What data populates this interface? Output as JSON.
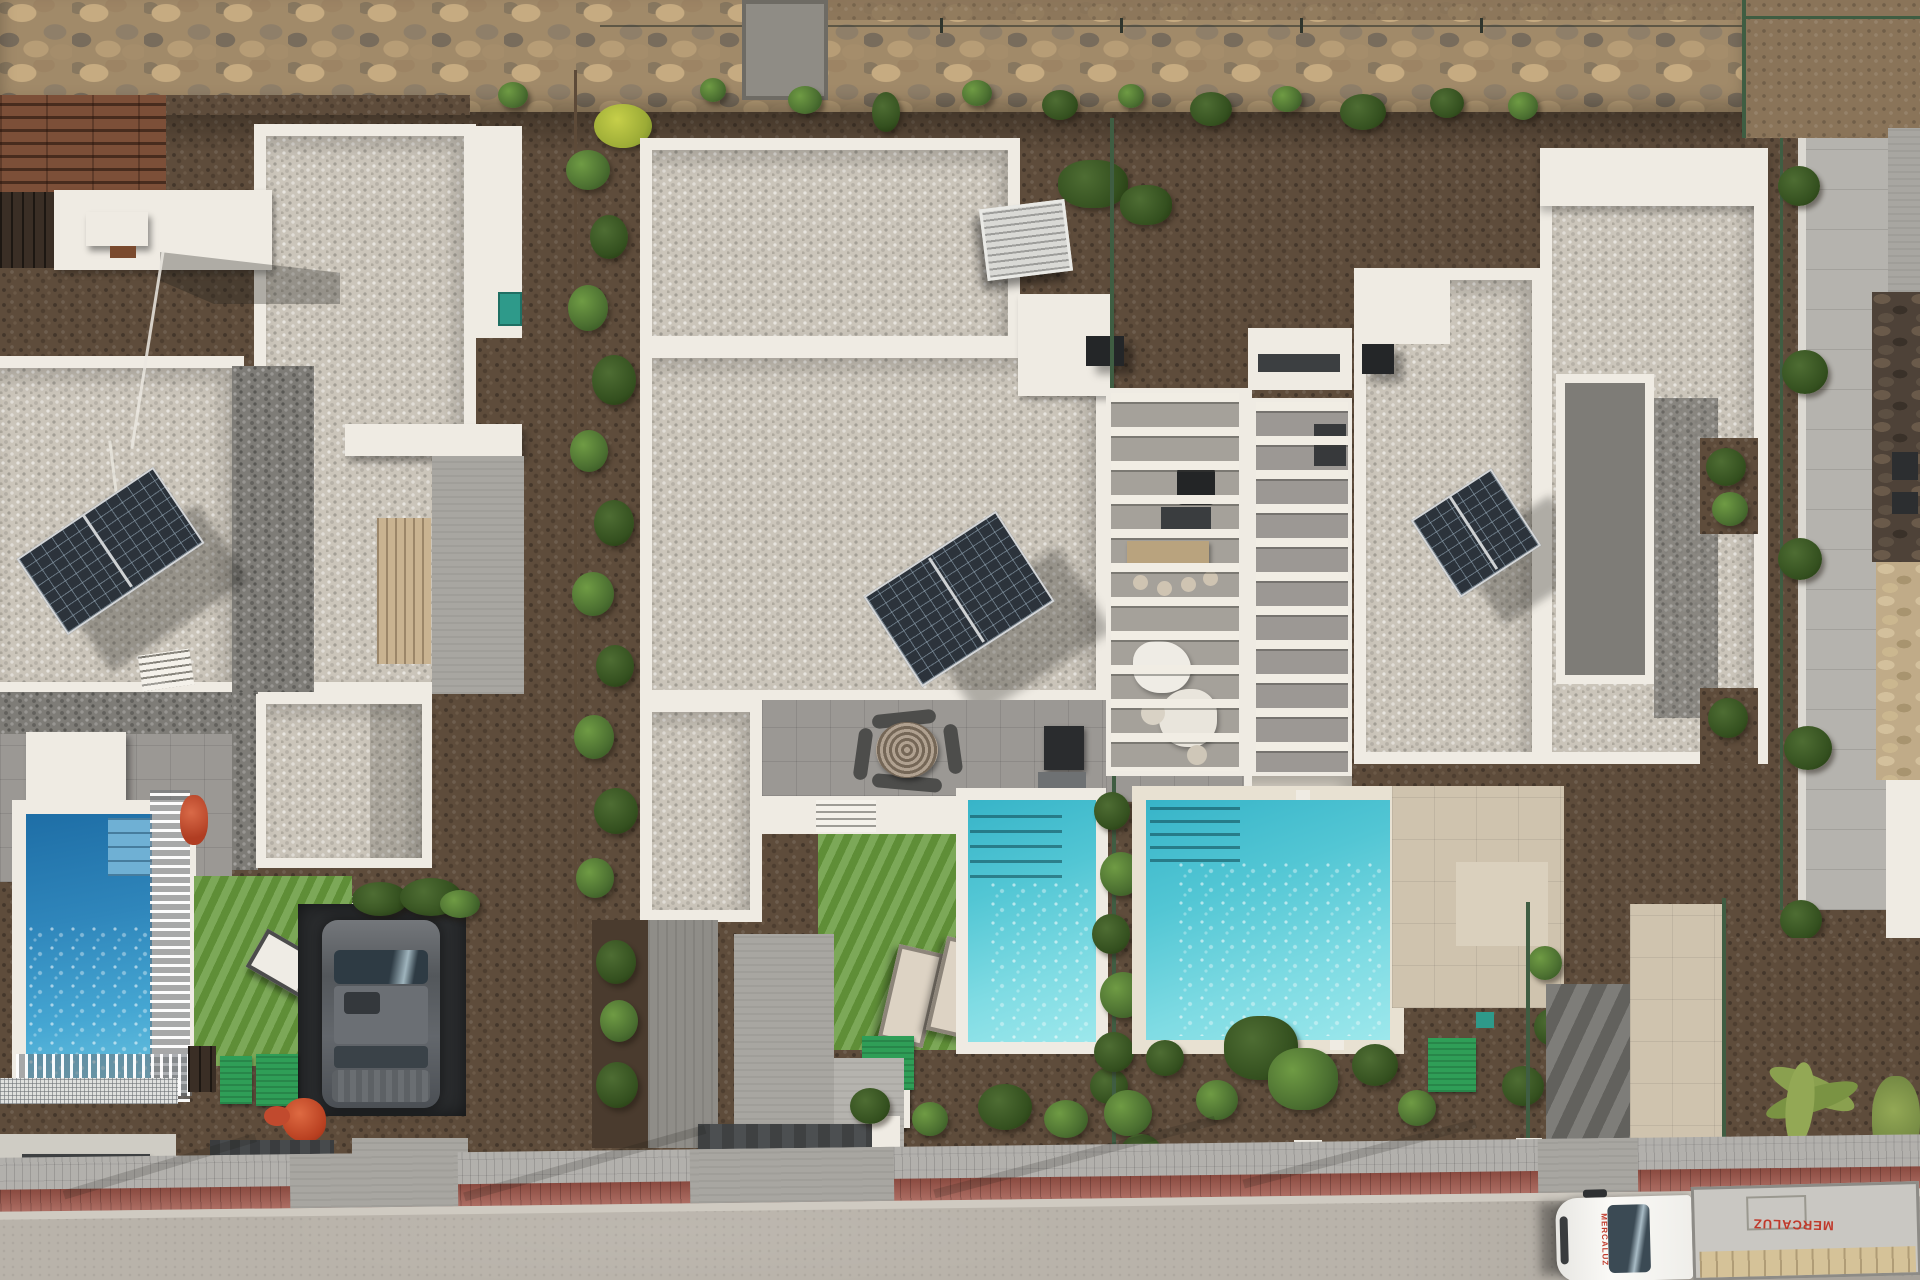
{
  "scene": {
    "type": "aerial-drone-photograph",
    "description": "Top-down drone view of three modern white villas with gravel flat roofs and solar panels, private pools and gardens, a rubble stone boundary wall at top, white pergola terraces between houses, and a street with sidewalk and a parked box truck at bottom right.",
    "villa_count": 3,
    "pool_count": 3
  },
  "palette": {
    "dirt": "#5e4c3b",
    "stone_wall": "#a18a69",
    "gravel_light": "#cbc5ba",
    "gravel_dark": "#7e7c77",
    "lawn": "#679a3c",
    "pool_deep": "#2f86bb",
    "pool_turquoise": "#52c6d4",
    "white_wall": "#efebe3",
    "asphalt": "#b9b3aa",
    "sidewalk": "#b2b0ac",
    "brick_stripe": "#a0564a",
    "terrace_beige": "#cfc3ae",
    "patio_grey": "#9b9894",
    "car_body": "#5a5e61",
    "statue_red": "#c14a2e",
    "truck_text": "#c0392b",
    "hedge_green": "#4c7031",
    "mat_green": "#2f9e57"
  },
  "truck": {
    "roof_text": "MERCALUZ",
    "side_text": "MERCALUZ"
  },
  "objects": [
    "stone boundary wall",
    "wooden pallets",
    "villa roofs with gravel",
    "solar panels",
    "air-conditioning units",
    "chimneys",
    "pergola with white beams",
    "outdoor furniture",
    "round braided table",
    "swimming pools",
    "sun loungers",
    "artificial lawn",
    "green doormats",
    "red rooster statue",
    "grey car in carport",
    "driveway gates",
    "hedges and fences",
    "sidewalk with red brick stripe",
    "street",
    "delivery box truck"
  ]
}
